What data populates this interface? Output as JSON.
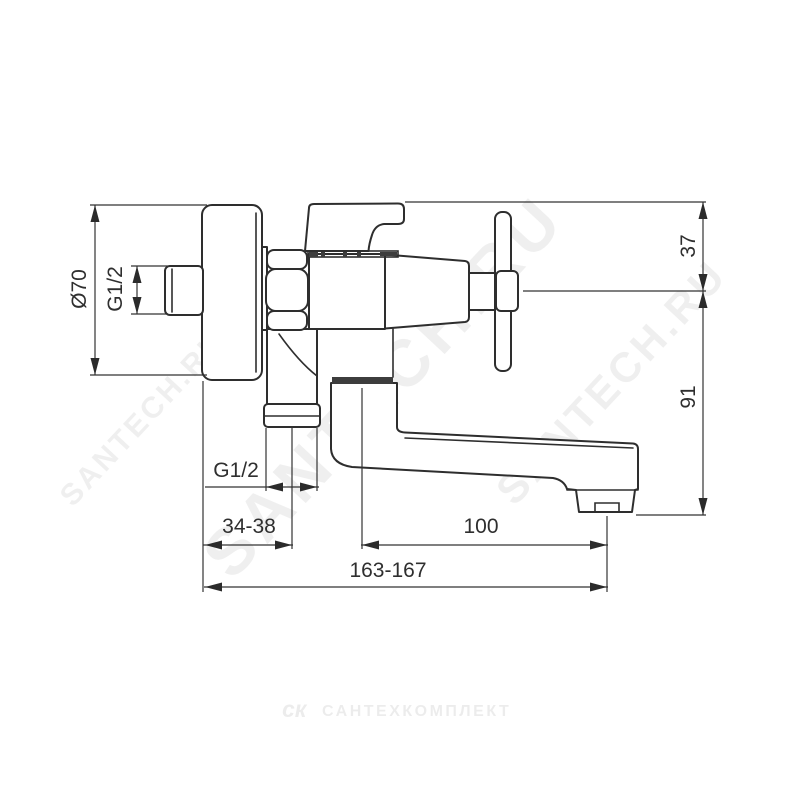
{
  "drawing": {
    "type": "faucet technical dimension drawing",
    "dimensions": {
      "escutcheon_diameter": "Ø70",
      "inlet_thread": "G1/2",
      "handle_offset": "37",
      "body_height": "91",
      "shower_thread": "G1/2",
      "wall_to_shower_outlet": "34-38",
      "outlet_reach": "100",
      "total_reach": "163-167"
    }
  },
  "watermarks": {
    "diagonal": "SANTECH.RU",
    "footer_logo": "ск",
    "footer_text": "САНТЕХКОМПЛЕКТ"
  },
  "colors": {
    "line": "#2e2e2e",
    "dimension_text": "#2f2f2f",
    "watermark": "#f0f0f0",
    "background": "#ffffff"
  }
}
